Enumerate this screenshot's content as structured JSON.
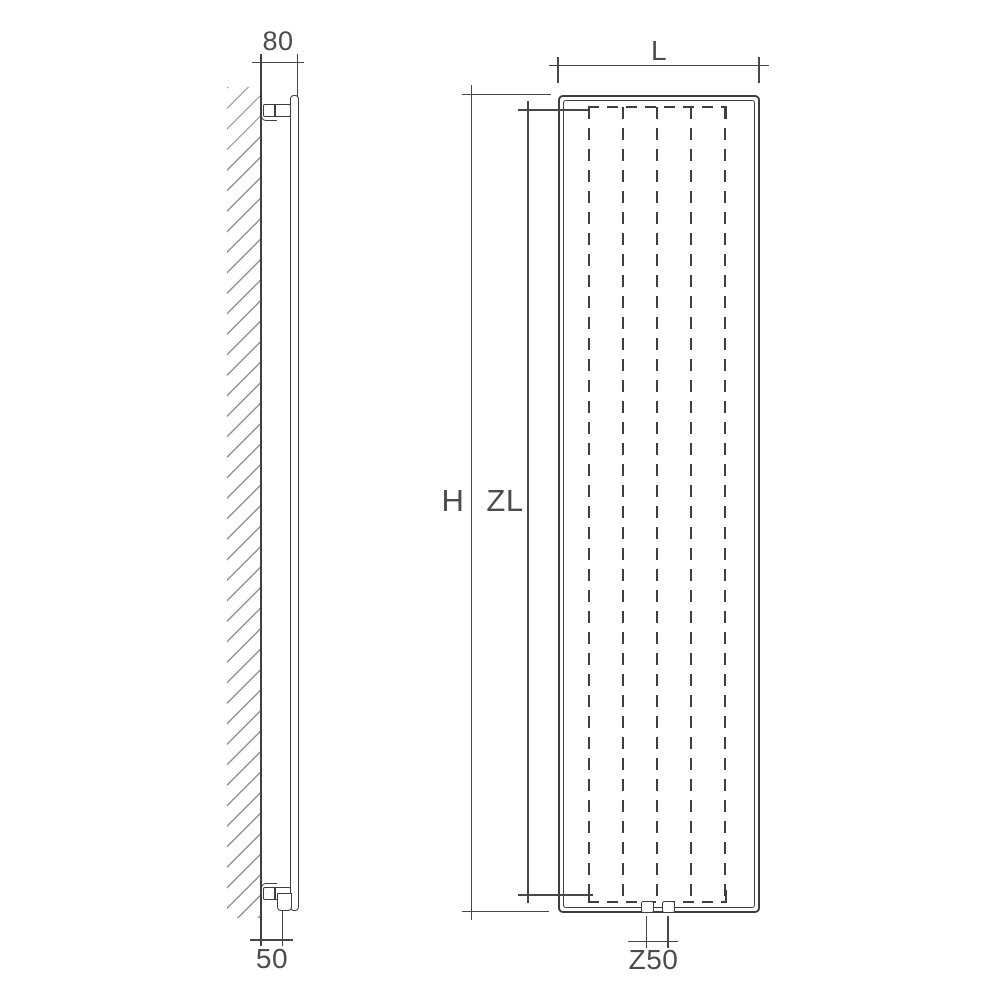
{
  "labels": {
    "depth": "80",
    "wall_to_pipe": "50",
    "width": "L",
    "height": "H",
    "convector_height": "ZL",
    "valve_spacing": "Z50"
  },
  "colors": {
    "line": "#3d3e41",
    "dimension": "#46474b",
    "hatch": "#8f9094",
    "text": "#4b4c50",
    "background": "#ffffff"
  }
}
